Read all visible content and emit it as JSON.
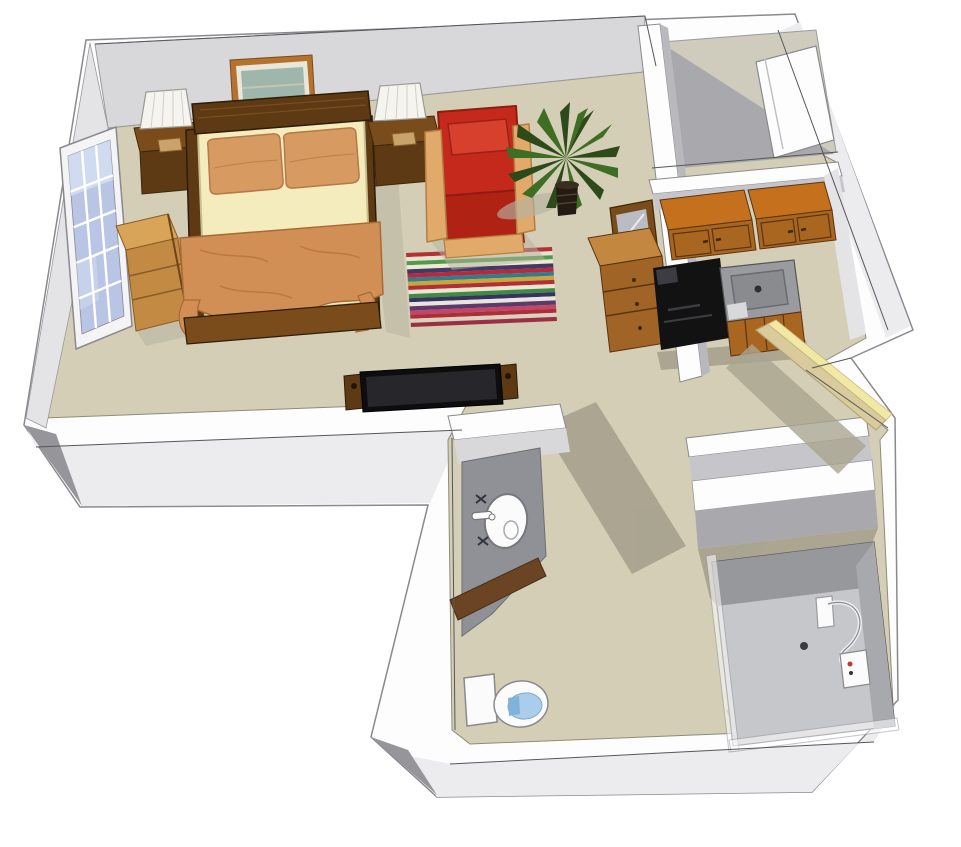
{
  "scene": {
    "type": "3d-floor-plan-rendering",
    "style": "sketchup-isometric",
    "unit": "studio-apartment"
  },
  "rooms": [
    {
      "id": "bedroom-living",
      "label": "bedroom / living area"
    },
    {
      "id": "kitchenette",
      "label": "kitchenette"
    },
    {
      "id": "entry-closet",
      "label": "entry closet"
    },
    {
      "id": "entry",
      "label": "entry with open door"
    },
    {
      "id": "hallway",
      "label": "hallway"
    },
    {
      "id": "bathroom",
      "label": "bathroom"
    },
    {
      "id": "shower-room",
      "label": "walk-in shower"
    }
  ],
  "furniture": [
    "window",
    "bookshelf",
    "nightstand-left",
    "table-lamp-left",
    "picture-frame",
    "double-bed",
    "nightstand-right",
    "table-lamp-right",
    "red-armchair",
    "potted-palm",
    "striped-area-rug",
    "flat-screen-tv",
    "dresser-with-mirror",
    "upper-cabinets",
    "black-range",
    "kitchen-sink-counter",
    "lower-cabinets",
    "closet-door-panel",
    "entry-door",
    "bathroom-vanity",
    "vanity-sink",
    "toilet",
    "shower-stall",
    "hand-shower",
    "shower-control-box",
    "linen-shelf"
  ],
  "colors": {
    "outline": "#55565a",
    "wall_top": "#fdfdfe",
    "wall_outer_face": "#ececef",
    "wall_bevel_dark": "#96969a",
    "wall_face_north": "#d8d8db",
    "wall_face_west": "#e4e4e7",
    "wall_face_shadow": "#b9b9bd",
    "wall_face_kitchen": "#c6c6ca",
    "closet_shadow": "#a9a9ad",
    "floor": "#d3ceb5",
    "floor_closet": "#cfccbd",
    "floor_shadow": "#a6a18e",
    "shadow_soft": "#b6b2a0",
    "wood_dark": "#5d3a14",
    "wood_darker": "#3f2709",
    "wood_mid": "#7a4c1c",
    "wood_light": "#d9a458",
    "wood_light_side": "#c28a42",
    "cab_top": "#c4701c",
    "cab_front": "#a96620",
    "mattress": "#f4ecbc",
    "pillow": "#d79a60",
    "blanket": "#d28f55",
    "chair_red": "#c4291b",
    "chair_red_dark": "#b02214",
    "chair_red_light": "#d6402c",
    "chair_wood": "#e2aa6a",
    "plant_dark": "#2c4a1a",
    "plant_mid": "#3f6d24",
    "pot_dark": "#241c14",
    "pot_rim": "#3a2e20",
    "frame_wood": "#b5722e",
    "frame_mat": "#e9e6da",
    "art": "#9fb6ad",
    "tv_black": "#0d0d0d",
    "tv_screen": "#26262b",
    "window_frame": "#f4f4f6",
    "pane": "#b9c5e4",
    "pane_light": "#d6def2",
    "appliance": "#121212",
    "appliance_hl": "#3c3c42",
    "counter": "#9a9b9f",
    "basin": "#8a8b8f",
    "counter_pad": "#d8d9db",
    "door_tan": "#d9cb9c",
    "door_edge_yellow": "#f2e8a6",
    "door_shadow": "#aaa590",
    "vanity_gray": "#8f9196",
    "vanity_wood": "#6b4423",
    "fixture_white": "#fbfbfc",
    "toilet_blue": "#a9cdea",
    "toilet_blue_dark": "#7fb3d8",
    "shower_pan": "#c6c7cb",
    "shower_wall": "#97989c",
    "shower_wall2": "#a8a9ad",
    "glass_white": "#ffffff",
    "mirror_glass": "#b9bcc2",
    "dresser_top": "#c4873f",
    "dresser_front": "#a06426",
    "lamp_shade": "#f6f4ee",
    "lamp_base": "#caa36a"
  },
  "rug": {
    "stripes": [
      "#b23236",
      "#e8e3d1",
      "#4f9a4c",
      "#efe8d2",
      "#403a66",
      "#b8293c",
      "#2f7d8e",
      "#c9a63a",
      "#b03038",
      "#ece5d0",
      "#3f8a45",
      "#37325f",
      "#e9e4dd",
      "#5c3a6c",
      "#c2456a",
      "#aa2f36",
      "#d8d2c0",
      "#9c2f42"
    ]
  }
}
